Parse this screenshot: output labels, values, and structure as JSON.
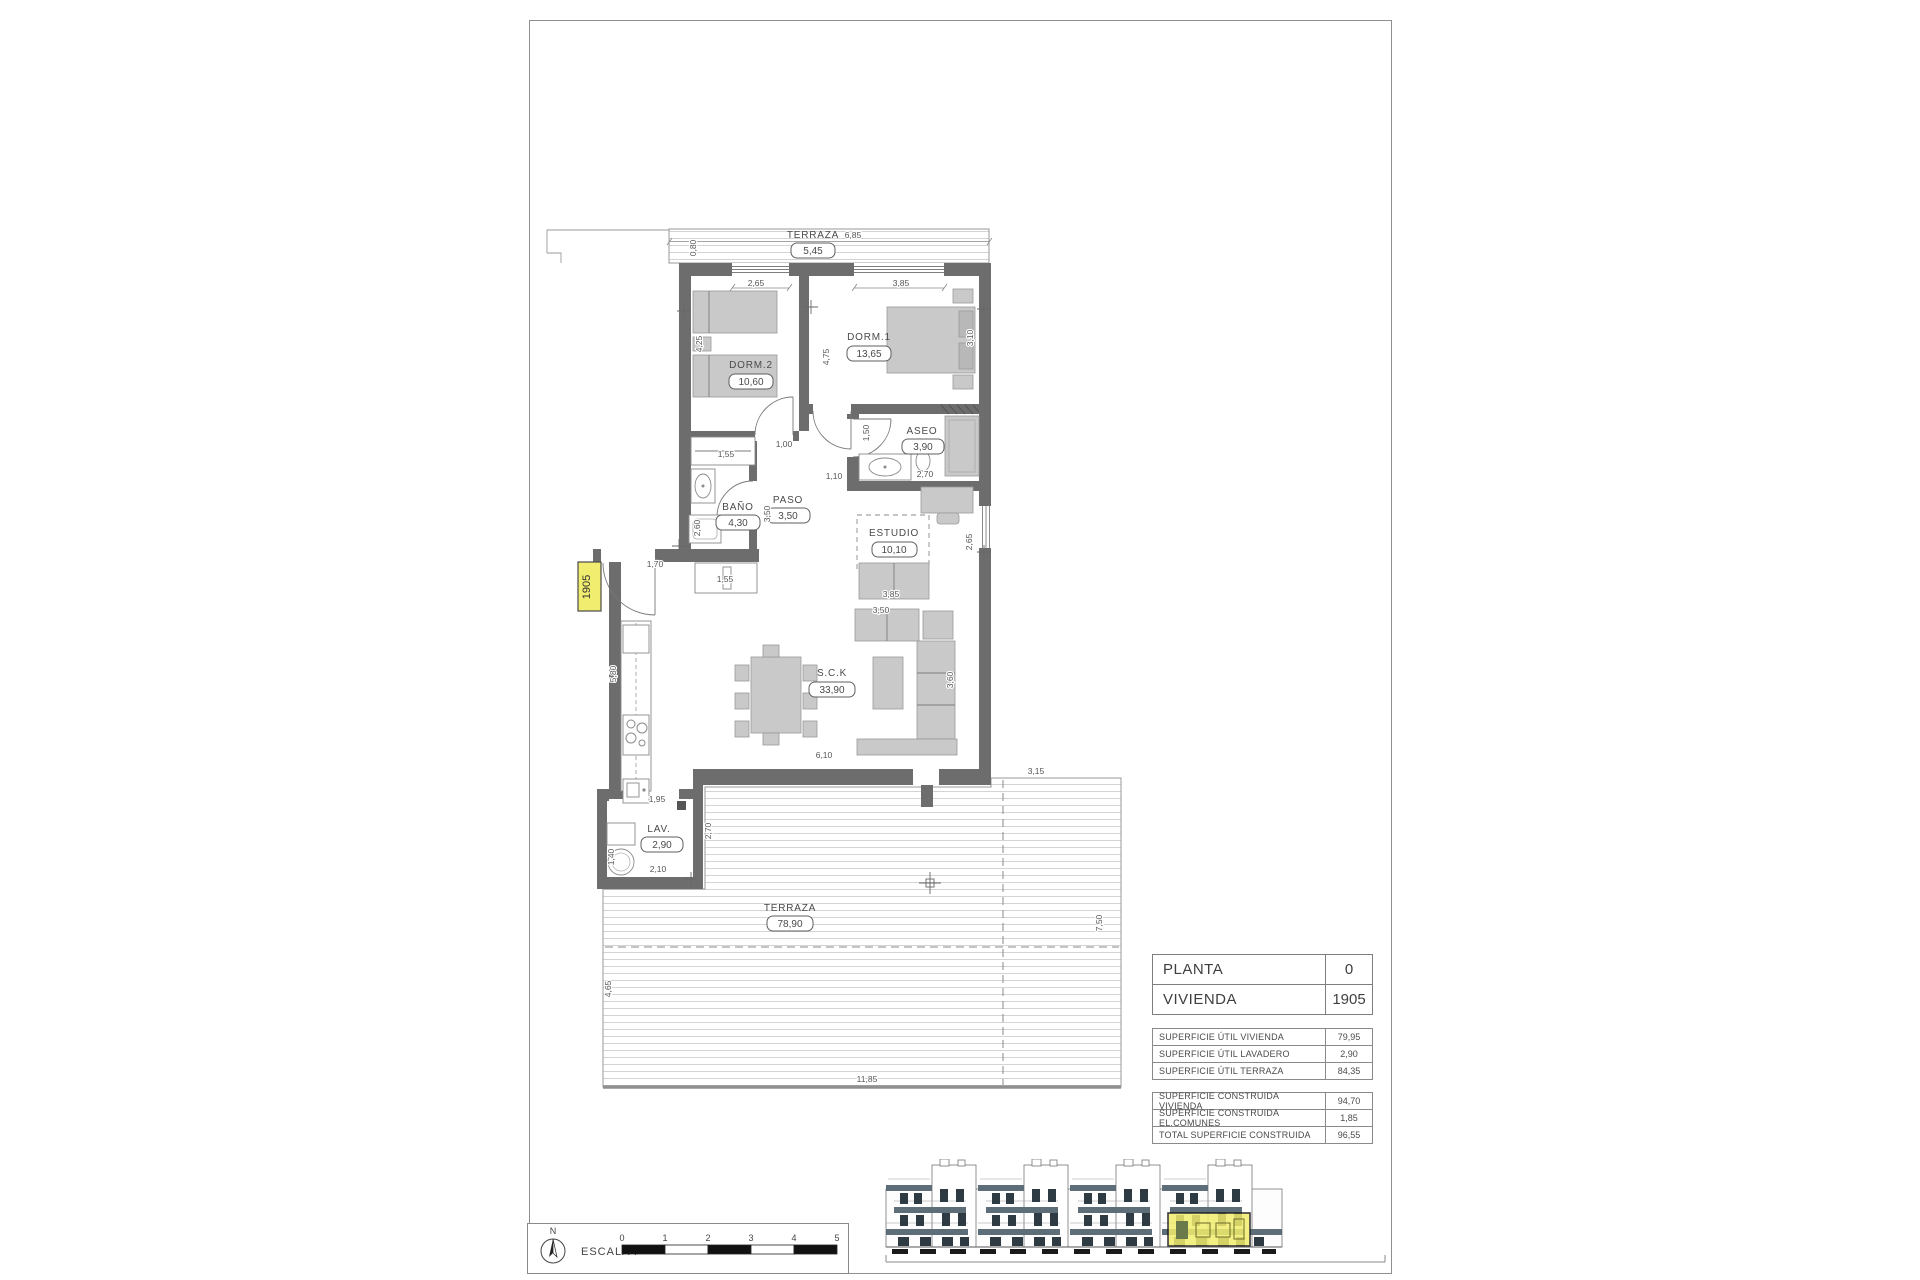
{
  "colors": {
    "wall": "#6d6d6d",
    "furniture": "#c9c9c9",
    "highlight_yellow": "#f1ed6e",
    "elevation_slab": "#5d6e78",
    "text": "#4a4a4a"
  },
  "plan": {
    "unit_tag": "1905",
    "rooms": {
      "terraza_top": {
        "name": "TERRAZA",
        "area": "5,45"
      },
      "dorm2": {
        "name": "DORM.2",
        "area": "10,60"
      },
      "dorm1": {
        "name": "DORM.1",
        "area": "13,65"
      },
      "aseo": {
        "name": "ASEO",
        "area": "3,90"
      },
      "bano": {
        "name": "BAÑO",
        "area": "4,30"
      },
      "paso": {
        "name": "PASO",
        "area": "3,50"
      },
      "estudio": {
        "name": "ESTUDIO",
        "area": "10,10"
      },
      "sck": {
        "name": "S.C.K",
        "area": "33,90"
      },
      "lav": {
        "name": "LAV.",
        "area": "2,90"
      },
      "terraza_main": {
        "name": "TERRAZA",
        "area": "78,90"
      }
    },
    "dims": {
      "terraza_top_len": "6,85",
      "terraza_top_depth": "0,80",
      "dorm2_window": "2,65",
      "dorm1_window": "3,85",
      "dorm2_depth": "4,25",
      "dorm1_inner": "4,75",
      "dorm1_depth": "3,10",
      "aseo_door": "1,50",
      "aseo_width": "2,70",
      "closet_a": "1,55",
      "closet_b": "1,55",
      "paso_a": "1,00",
      "paso_b": "1,10",
      "paso_depth": "3,50",
      "bano_depth": "2,60",
      "estudio_width": "3,85",
      "estudio_sofa": "3,50",
      "estudio_depth": "2,65",
      "sck_width": "6,10",
      "sck_sofa": "3,60",
      "kitchen_len": "5,80",
      "entrance_door": "1,70",
      "lav_top": "1,95",
      "lav_bottom": "2,10",
      "lav_left": "1,40",
      "lav_right": "2,70",
      "terrace_top_right": "3,15",
      "terrace_right": "7,50",
      "terrace_left": "4,65",
      "terrace_bottom": "11,85"
    }
  },
  "info_table": {
    "rows": [
      {
        "label": "PLANTA",
        "value": "0"
      },
      {
        "label": "VIVIENDA",
        "value": "1905"
      }
    ]
  },
  "areas_util": {
    "rows": [
      {
        "label": "SUPERFICIE ÚTIL VIVIENDA",
        "value": "79,95"
      },
      {
        "label": "SUPERFICIE ÚTIL LAVADERO",
        "value": "2,90"
      },
      {
        "label": "SUPERFICIE ÚTIL TERRAZA",
        "value": "84,35"
      }
    ]
  },
  "areas_construida": {
    "rows": [
      {
        "label": "SUPERFICIE CONSTRUIDA VIVIENDA",
        "value": "94,70"
      },
      {
        "label": "SUPERFICIE CONSTRUIDA EL.COMUNES",
        "value": "1,85"
      },
      {
        "label": "TOTAL SUPERFICIE CONSTRUIDA",
        "value": "96,55"
      }
    ]
  },
  "escala": {
    "label": "ESCALA :",
    "north": "N",
    "ticks": [
      "0",
      "1",
      "2",
      "3",
      "4",
      "5"
    ]
  }
}
